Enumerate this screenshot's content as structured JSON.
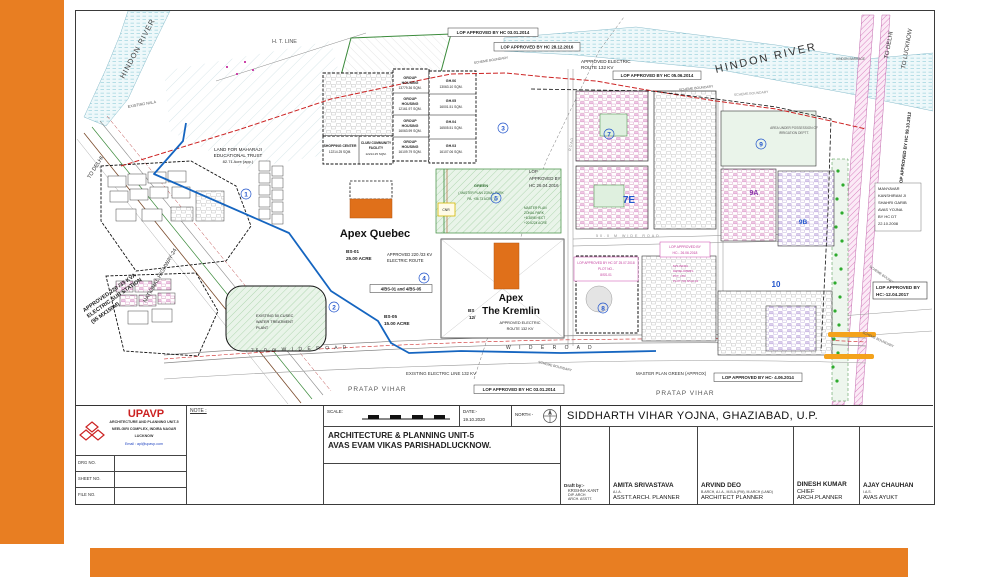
{
  "slide": {
    "accent_color": "#E87E22"
  },
  "title_block": {
    "org": {
      "name": "UPAVP",
      "line1": "ARCHITECTURE AND PLANNING UNIT-5",
      "line2": "NEELGIRI COMPLEX, INDIRA NAGAR",
      "line3": "LUCKNOW",
      "email": "Email : apl@upavp.com"
    },
    "fields": {
      "drg": "DRG NO.",
      "sheet": "SHEET NO.",
      "file": "FILE NO."
    },
    "note_label": "NOTE :",
    "scale_label": "SCALE:",
    "date_label": "DATE:-",
    "date_value": "19.10.2020",
    "north_label": "NORTH -",
    "unit_line1": "ARCHITECTURE & PLANNING UNIT-5",
    "unit_line2": "AVAS EVAM VIKAS PARISHADLUCKNOW.",
    "project_title": "SIDDHARTH VIHAR YOJNA, GHAZIABAD, U.P.",
    "draft_by": {
      "label": "Draft by:-",
      "name": "KRISHNA KANT",
      "l1": "DIP. ARCH",
      "l2": "ARCH. ASSTT."
    },
    "staff": [
      {
        "name": "AMITA SRIVASTAVA",
        "quals": "A.I.A.",
        "role": "ASSTT.ARCH. PLANNER"
      },
      {
        "name": "ARVIND DEO",
        "quals": "B.ARCH, A.I.A., M.B.A.(PM), M.ARCH (LAND)",
        "role": "ARCHITECT PLANNER"
      },
      {
        "name": "DINESH KUMAR",
        "quals": "",
        "role": "CHIEF ARCH.PLANNER"
      },
      {
        "name": "AJAY CHAUHAN",
        "quals": "I.A.S.",
        "role": "AVAS AYUKT"
      }
    ]
  },
  "map": {
    "labels": {
      "hindon_river_left": "HINDON RIVER",
      "hindon_river_right": "HINDON RIVER",
      "ht_line": "H.  T.  LINE",
      "existing_nala": "EXISTING NALA",
      "to_delhi_right": "TO DELHI",
      "to_lucknow": "TO LUCKNOW",
      "hindon_barrage": "HINDON BARRAGE",
      "to_delhi_left": "TO DELHI",
      "national_highway": "NATIONAL HIGHWAY-24",
      "sub_station_l1": "APPROVED 220 /33 KVA",
      "sub_station_l2": "ELECTRIC SUB STATION",
      "sub_station_l3": "(95 MX150M)",
      "land_trust_l1": "LAND FOR MAHARAJI",
      "land_trust_l2": "EDUCATIONAL TRUST",
      "land_trust_l3": "82.71 Acre (app.)",
      "lop_top1": "LOP APPROVED BY HC 03.01.2014",
      "lop_top2": "LOP APPROVED BY HC 28.12.2016",
      "lop_top3": "LOP APPROVED BY HC 05.06.2014",
      "approved_electric_l1": "APPROVED ELECTRIC",
      "approved_electric_l2": "ROUTE 132 KV",
      "scheme_boundary": "SCHEME BOUNDARY",
      "lop_right_vert": "LOP APPROVED BY HC 09.10.2012",
      "manyavar_l1": "MANYAVAR",
      "manyavar_l2": "KANSHIRAM JI",
      "manyavar_l3": "SHAHRI GARIB",
      "manyavar_l4": "AVAS YOJNA",
      "manyavar_l5": "BY HC DT",
      "manyavar_l6": "22.10.2008",
      "lop_12_04_2017_l1": "LOP APPROVED BY",
      "lop_12_04_2017_l2": "HC:-12.04.2017",
      "area_irrigation_l1": "AREA UNDER POSSESSION OF",
      "area_irrigation_l2": "IRRIGATION DEPTT.",
      "shopping_l1": "SHOPPING CENTER",
      "shopping_l2": "12214.25 SQM.",
      "club_l1": "CLUB/ COMMUNITY",
      "club_l2": "FACILITY",
      "club_l3": "12214.25 SQM.",
      "green_l1": "GREEN",
      "green_l2": "( MASTER PLAN ZONAL PARK",
      "green_l3": "PA. +36.73 ACRE )",
      "zonal_l1": "MASTER PLAN",
      "zonal_l2": "ZONAL PARK",
      "zonal_l3": "+8.3898 HECT",
      "zonal_l4": "+20.6224 ACRE",
      "cnr": "CNR",
      "lop_26_04_2016_l1": "LOP",
      "lop_26_04_2016_l2": "APPROVED BY",
      "lop_26_04_2016_l3": "HC 26.04.2016",
      "apex_quebec": "Apex Quebec",
      "apex_kremlin_l1": "Apex",
      "apex_kremlin_l2": "The Kremlin",
      "bs01_l1": "BS-01",
      "bs01_l2": "25.00 ACRE",
      "bs05_l1": "BS-05",
      "bs05_l2": "15.00 ACRE",
      "bs12_l1": "BS",
      "bs12_l2": "12/",
      "bs_combo": "4/BS-01 and 4/BS-05",
      "route220_l1": "APPROVED 220 /33 KV",
      "route220_l2": "ELECTRIC ROUTE",
      "route132_l1": "APPROVED ELECTRIC",
      "route132_l2": "ROUTE 132 KV",
      "water_plant_l1": "EXISTING 50 CUSEC",
      "water_plant_l2": "WATER TREATMENT",
      "water_plant_l3": "PLANT",
      "wide_road_75": "75.0 m    W I D E    R O A D",
      "wide_road_mid": "W I D E      R O A D",
      "road_50m": "50.0 M   WIDE   ROAD",
      "road_vert": "R O A D",
      "existing_electric_bottom": "EXISTING ELECTRIC LINE 132 KV",
      "lop_bottom1": "LOP APPROVED BY HC 03.01.2014",
      "master_plan_green": "MASTER PLAN GREEN (APPROX)",
      "pratap_vihar": "PRATAP VIHAR",
      "lop_bottom2": "LOP APPROVED BY HC- 4.06.2014",
      "lop_25_07_2018_l1": "LOP APPROVED BY HC DT 25.07.2018",
      "lop_25_07_2018_l2": "PLOT NO.-",
      "lop_25_07_2018_l3": "8/SS-01",
      "lop_26_06_2018_l1": "LOP APPROVED BY",
      "lop_26_06_2018_l2": "HC:- 26.06.2018",
      "ms_infra_l1": "M/S INFRA",
      "ms_infra_l2": "DEVELOPERS",
      "ms_infra_l3": "PVT. LTD",
      "ms_infra_l4": "PLOT NO.8/GH-01"
    },
    "group_housing": [
      {
        "l1": "GROUP",
        "l2": "HOUSING",
        "l3": "13779.36 SQM."
      },
      {
        "l1": "GROUP",
        "l2": "HOUSING",
        "l3": "12161.97 SQM."
      },
      {
        "l1": "GROUP",
        "l2": "HOUSING",
        "l3": "16063.99 SQM."
      },
      {
        "l1": "GROUP",
        "l2": "HOUSING",
        "l3": "16109.79 SQM."
      }
    ],
    "gh_plots": [
      {
        "l1": "GH.06",
        "l2": "13063.10 SQM."
      },
      {
        "l1": "GH.05",
        "l2": "16001.51 SQM."
      },
      {
        "l1": "GH.04",
        "l2": "16505.51 SQM."
      },
      {
        "l1": "GH.03",
        "l2": "16107.06 SQM."
      }
    ],
    "sectors": {
      "s1": "1",
      "s2": "2",
      "s3": "3",
      "s4": "4",
      "s5": "5",
      "s7": "7",
      "s7e": "7E",
      "s8": "8",
      "s9": "9",
      "s9a": "9A",
      "s9b": "9B",
      "s10": "10"
    }
  }
}
